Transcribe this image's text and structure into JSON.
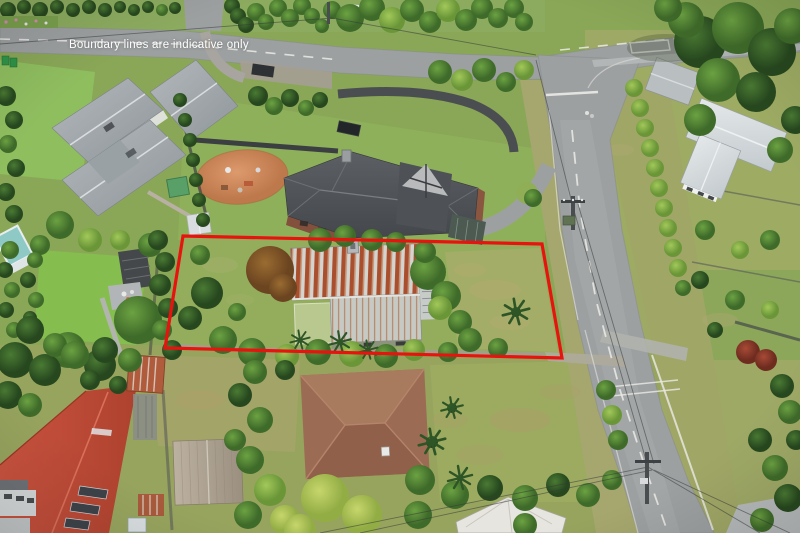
{
  "overlay": {
    "caption": "Boundary lines are indicative only",
    "caption_color": "#ffffff"
  },
  "boundary": {
    "color": "#e8130e",
    "stroke_width": 3.2,
    "shape": "quadrilateral",
    "points": "183,236 542,244 562,358 165,348"
  },
  "scene": {
    "type": "aerial-photograph",
    "description": "Aerial drone photo of a residential section outlined in red, with neighbouring houses, gardens, hedges, a playground and a road junction",
    "palette": {
      "grass": "#8aa757",
      "road": "#9da0a1",
      "road_marking": "#ebebe7",
      "tree_dark": "#2f5a28",
      "tree_light": "#9cc455",
      "subject_roof_rust": "#aa4f2e",
      "subject_roof_silver": "#d3d4cf",
      "neighbour_roof_dark": "#54585c",
      "neighbour_roof_red": "#c14b38",
      "neighbour_roof_brown": "#9c6b54",
      "playground_surface": "#cd8a5e",
      "pool_teal": "#8fc9c6"
    }
  }
}
